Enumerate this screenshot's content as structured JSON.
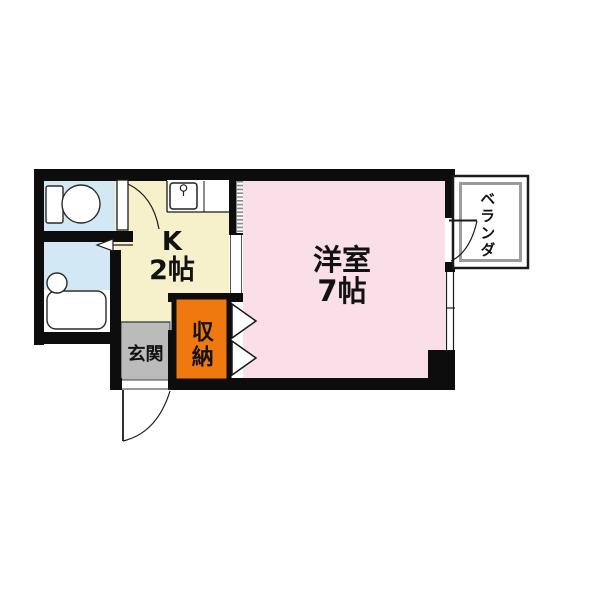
{
  "floorplan": {
    "rooms": {
      "kitchen": {
        "name": "K",
        "area": "2帖",
        "color": "#F6F0CB"
      },
      "main_room": {
        "name": "洋室",
        "area": "7帖",
        "color": "#FADFE8"
      },
      "entrance": {
        "name": "玄関",
        "color": "#BBBBBB"
      },
      "closet": {
        "name": "収納",
        "color": "#F0790F"
      },
      "balcony": {
        "name": "ベランダ",
        "color": "#FFFFFF"
      },
      "toilet": {
        "color": "#D2E9F5"
      },
      "bathroom": {
        "color": "#D2E9F5"
      }
    },
    "wall_color": "#0D0D0D"
  }
}
